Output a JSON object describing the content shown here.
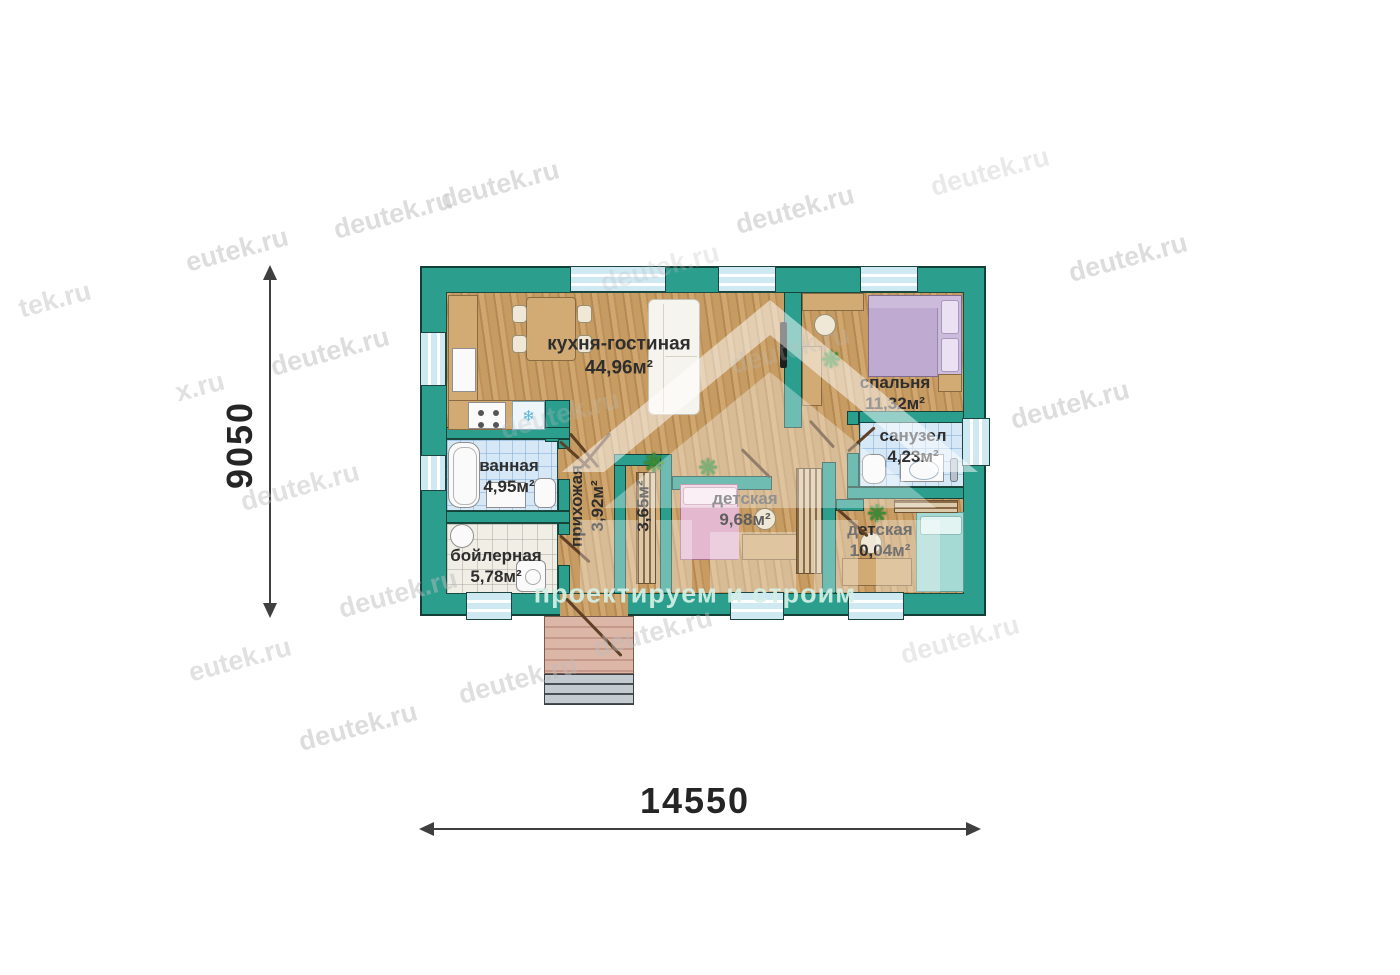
{
  "dimensions": {
    "horizontal": "14550",
    "vertical": "9050"
  },
  "rooms": [
    {
      "name": "кухня-гостиная",
      "area": "44,96м²"
    },
    {
      "name": "спальня",
      "area": "11,32м²"
    },
    {
      "name": "санузел",
      "area": "4,23м²"
    },
    {
      "name": "ванная",
      "area": "4,95м²"
    },
    {
      "name": "бойлерная",
      "area": "5,78м²"
    },
    {
      "name": "детская",
      "area": "9,68м²"
    },
    {
      "name": "детская",
      "area": "10,04м²"
    },
    {
      "name": "прихожая",
      "area": "3,92м²"
    },
    {
      "name": "",
      "area": "3,65м²"
    }
  ],
  "watermark": {
    "slogan": "проектируем и строим",
    "items": [
      {
        "text": "deutek.ru",
        "x": 500,
        "y": 185,
        "o": 0.5
      },
      {
        "text": "deutek.ru",
        "x": 795,
        "y": 210,
        "o": 0.5
      },
      {
        "text": "deutek.ru",
        "x": 990,
        "y": 172,
        "o": 0.32
      },
      {
        "text": "deutek.ru",
        "x": 1128,
        "y": 258,
        "o": 0.5
      },
      {
        "text": "deutek.ru",
        "x": 393,
        "y": 215,
        "o": 0.5
      },
      {
        "text": "eutek.ru",
        "x": 237,
        "y": 250,
        "o": 0.5
      },
      {
        "text": "tek.ru",
        "x": 55,
        "y": 300,
        "o": 0.45
      },
      {
        "text": "deutek.ru",
        "x": 330,
        "y": 352,
        "o": 0.5
      },
      {
        "text": "x.ru",
        "x": 200,
        "y": 387,
        "o": 0.45
      },
      {
        "text": "deutek.ru",
        "x": 560,
        "y": 415,
        "o": 0.28
      },
      {
        "text": "deutek.ru",
        "x": 790,
        "y": 350,
        "o": 0.25
      },
      {
        "text": "deutek.ru",
        "x": 1070,
        "y": 405,
        "o": 0.5
      },
      {
        "text": "deutek.ru",
        "x": 300,
        "y": 487,
        "o": 0.45
      },
      {
        "text": "deutek.ru",
        "x": 398,
        "y": 594,
        "o": 0.48
      },
      {
        "text": "deutek.ru",
        "x": 660,
        "y": 268,
        "o": 0.28
      },
      {
        "text": "eutek.ru",
        "x": 240,
        "y": 660,
        "o": 0.45
      },
      {
        "text": "deutek.ru",
        "x": 358,
        "y": 727,
        "o": 0.5
      },
      {
        "text": "deutek.ru",
        "x": 518,
        "y": 680,
        "o": 0.48
      },
      {
        "text": "deutek.ru",
        "x": 653,
        "y": 633,
        "o": 0.45
      },
      {
        "text": "deutek.ru",
        "x": 960,
        "y": 640,
        "o": 0.32
      }
    ]
  },
  "icons": {
    "plant": "❋",
    "snowflake": "❄"
  },
  "colors": {
    "wall": "#2b9e8e",
    "wood": "#c49a62",
    "tile_blue": "#d6e8f6",
    "tile_white": "#f1eee6",
    "window": "#cfe9f3",
    "dimension": "#3f3f3f",
    "watermark": "#bdbdbd",
    "slogan": "#d5f0e5",
    "door": "#5f4026"
  }
}
